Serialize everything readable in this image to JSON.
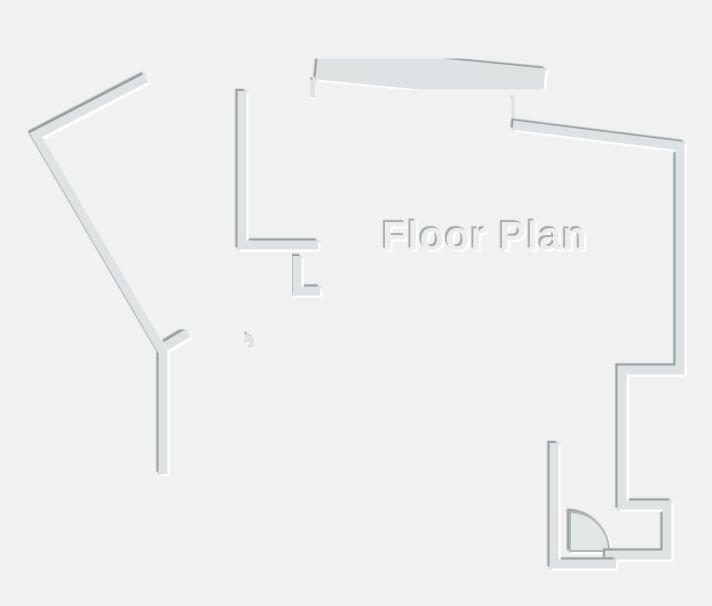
{
  "title": "Floor Plan",
  "canvas": {
    "width": 712,
    "height": 606,
    "background": "#f0f1f1"
  },
  "style": {
    "wall_fill": "#dfe2e2",
    "shadow_dark": "#9aa0a0",
    "shadow_light": "#ffffff",
    "door_fill": "#e3e6e6",
    "door_stroke": "#b3b7b7",
    "title_color": "#eceeee",
    "title_shadow_dark": "#a8abab"
  },
  "floor_plan": {
    "default_wall_width": 9,
    "door": {
      "name": "door-swing",
      "path": "M 570,512 A 39,39 0 0 1 609,551 L 570,551 Z",
      "stroke_width": 2
    },
    "walls": [
      {
        "name": "partition-upper-left-a",
        "points": [
          [
            220,
            89
          ],
          [
            220,
            282
          ]
        ]
      },
      {
        "name": "partition-upper-left-b",
        "points": [
          [
            242,
            91
          ],
          [
            242,
            245
          ],
          [
            318,
            245
          ]
        ]
      },
      {
        "name": "closet-corner-upper",
        "points": [
          [
            316,
            217
          ],
          [
            316,
            245
          ]
        ]
      },
      {
        "name": "stub-below-h1",
        "points": [
          [
            253,
            256
          ],
          [
            253,
            302
          ]
        ]
      },
      {
        "name": "closet-corner-lower",
        "points": [
          [
            297,
            256
          ],
          [
            297,
            291
          ],
          [
            320,
            291
          ]
        ]
      },
      {
        "name": "stub-diagonal",
        "points": [
          [
            161,
            349
          ],
          [
            188,
            333
          ]
        ]
      },
      {
        "name": "stub-h2",
        "points": [
          [
            194,
            339
          ],
          [
            214,
            339
          ]
        ]
      },
      {
        "name": "door-jamb-step",
        "points": [
          [
            246,
            334
          ],
          [
            246,
            340
          ],
          [
            252,
            340
          ],
          [
            252,
            347
          ]
        ],
        "width": 5
      },
      {
        "name": "partition-room1-right",
        "points": [
          [
            291,
            344
          ],
          [
            291,
            470
          ]
        ]
      },
      {
        "name": "wall-h3",
        "points": [
          [
            258,
            342
          ],
          [
            344,
            342
          ]
        ]
      },
      {
        "name": "partition-room2-right",
        "points": [
          [
            367,
            346
          ],
          [
            367,
            470
          ]
        ]
      },
      {
        "name": "cap-room2",
        "points": [
          [
            360,
            343
          ],
          [
            374,
            343
          ]
        ]
      },
      {
        "name": "partition-room3-right",
        "points": [
          [
            446,
            346
          ],
          [
            446,
            470
          ]
        ]
      },
      {
        "name": "cap-room3",
        "points": [
          [
            409,
            342
          ],
          [
            463,
            342
          ]
        ]
      },
      {
        "name": "jamb-tick",
        "points": [
          [
            438,
            350
          ],
          [
            438,
            361
          ]
        ],
        "width": 4
      },
      {
        "name": "exterior-left",
        "points": [
          [
            146,
            78
          ],
          [
            36,
            135
          ],
          [
            163,
            352
          ],
          [
            163,
            474
          ]
        ]
      },
      {
        "name": "bay-band-top",
        "points": [
          [
            317,
            63
          ],
          [
            544,
            85
          ]
        ],
        "width": 33
      },
      {
        "name": "bay-connector-left",
        "points": [
          [
            314,
            80
          ],
          [
            311,
            97
          ]
        ]
      },
      {
        "name": "bay-connector-right",
        "points": [
          [
            512,
            98
          ],
          [
            514,
            126
          ]
        ]
      },
      {
        "name": "exterior-right",
        "points": [
          [
            513,
            125
          ],
          [
            680,
            146
          ],
          [
            680,
            370
          ],
          [
            622,
            370
          ],
          [
            622,
            505
          ],
          [
            667,
            505
          ],
          [
            667,
            555
          ],
          [
            605,
            555
          ]
        ]
      },
      {
        "name": "window-tab-upper",
        "points": [
          [
            654,
            220
          ],
          [
            676,
            220
          ]
        ]
      },
      {
        "name": "window-tab-lower",
        "points": [
          [
            654,
            281
          ],
          [
            676,
            281
          ]
        ]
      },
      {
        "name": "vestibule-wall",
        "points": [
          [
            554,
            443
          ],
          [
            554,
            564
          ],
          [
            616,
            564
          ]
        ]
      },
      {
        "name": "exterior-bottom",
        "points": [
          [
            159,
            470
          ],
          [
            554,
            470
          ]
        ]
      }
    ]
  }
}
